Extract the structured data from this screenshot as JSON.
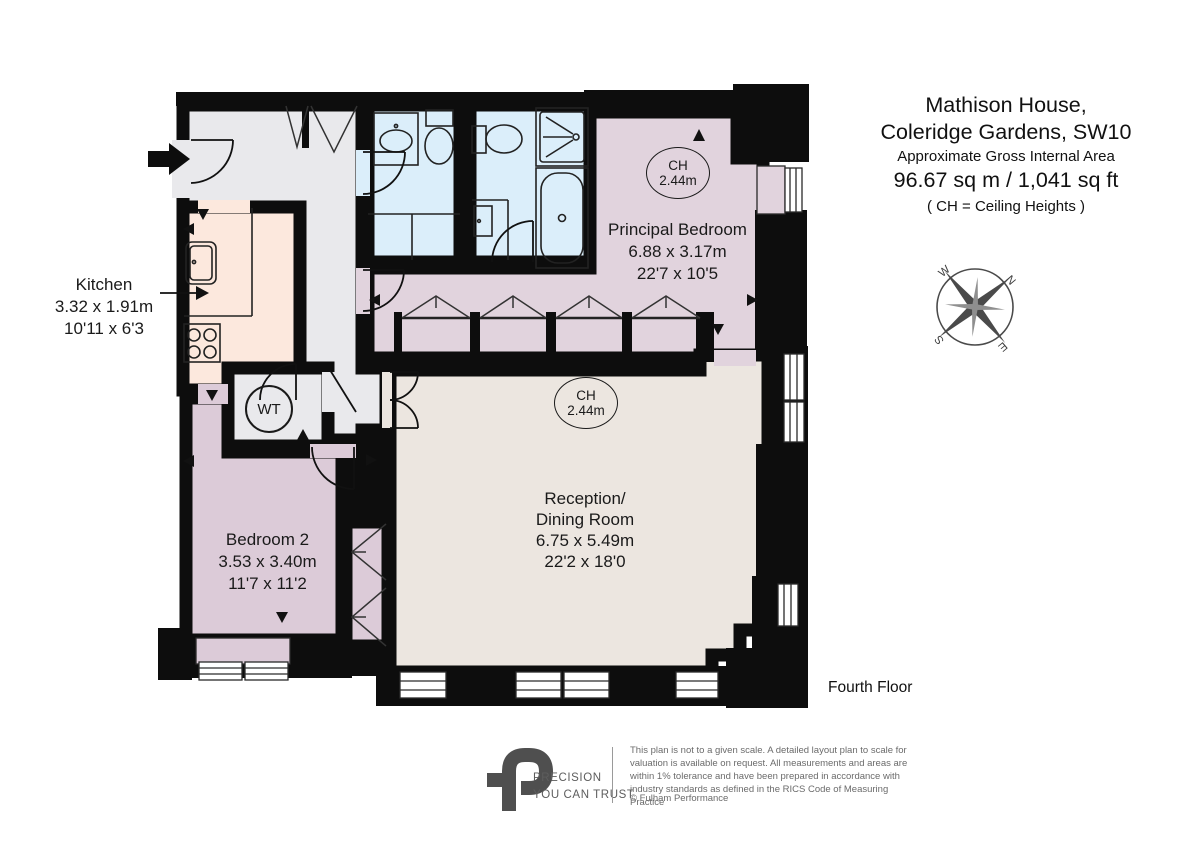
{
  "title": {
    "line1": "Mathison House,",
    "line2": "Coleridge Gardens, SW10",
    "area_label": "Approximate Gross Internal Area",
    "area_value": "96.67 sq m  /  1,041 sq ft",
    "ch_note": "( CH = Ceiling Heights )"
  },
  "floor_label": "Fourth Floor",
  "rooms": {
    "principal_bedroom": {
      "name": "Principal Bedroom",
      "metric": "6.88 x 3.17m",
      "imperial": "22'7 x 10'5",
      "ch_label": "CH",
      "ch_value": "2.44m"
    },
    "reception": {
      "name_line1": "Reception/",
      "name_line2": "Dining Room",
      "metric": "6.75 x 5.49m",
      "imperial": "22'2 x 18'0",
      "ch_label": "CH",
      "ch_value": "2.44m"
    },
    "bedroom2": {
      "name": "Bedroom 2",
      "metric": "3.53 x 3.40m",
      "imperial": "11'7 x 11'2"
    },
    "kitchen": {
      "name": "Kitchen",
      "metric": "3.32 x 1.91m",
      "imperial": "10'11 x 6'3"
    },
    "wt_closet": {
      "label": "WT"
    }
  },
  "compass": {
    "north": "N",
    "east": "E",
    "south": "S",
    "west": "W"
  },
  "footer": {
    "brand_line1": "PRECISION",
    "brand_line2": "YOU CAN TRUST",
    "disclaimer": "This plan is not to a given scale. A detailed layout plan to scale for valuation is available on request. All measurements and areas are within 1% tolerance and have been prepared in accordance with industry standards as defined in the RICS Code of Measuring Practice",
    "copyright": "© Fulham Performance"
  },
  "colors": {
    "wall": "#0d0d0d",
    "hall": "#e9e9ec",
    "kitchen": "#fce8dd",
    "bathroom": "#dbeefa",
    "bedroom": "#e1d3dd",
    "bedroom2": "#dccbd8",
    "reception": "#ece6e0"
  }
}
